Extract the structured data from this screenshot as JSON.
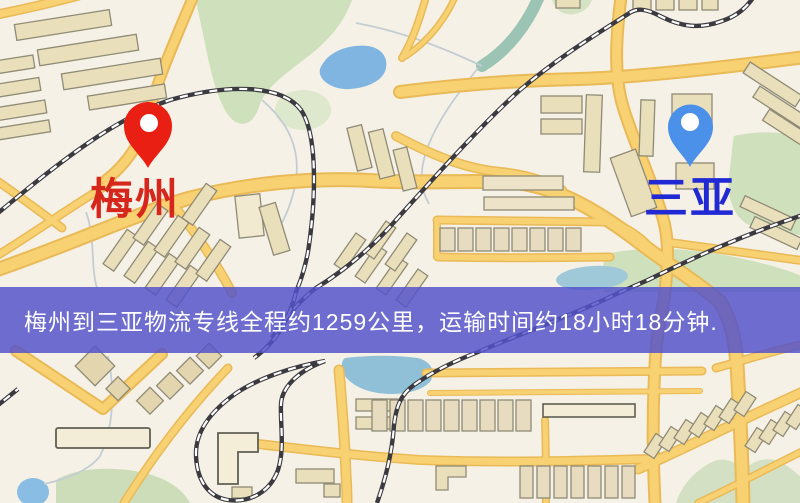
{
  "banner": {
    "text": "梅州到三亚物流专线全程约1259公里，运输时间约18小时18分钟.",
    "bg_color": "rgba(84,82,202,0.84)",
    "text_color": "#ffffff"
  },
  "markers": {
    "origin": {
      "label": "梅州",
      "pin_color": "#e81f12",
      "label_color": "#d7261b"
    },
    "destination": {
      "label": "三亚",
      "pin_color": "#4b90e9",
      "label_color": "#2029d4"
    }
  },
  "map": {
    "colors": {
      "background": "#f6f1e6",
      "road_fill": "#f7d172",
      "road_casing": "#e9ba57",
      "park": "#cfe0bc",
      "water": "#7fb5e0",
      "water_shallow": "#8fc0d8",
      "building": "#eadfbb",
      "railway": "#3a3a40"
    }
  }
}
